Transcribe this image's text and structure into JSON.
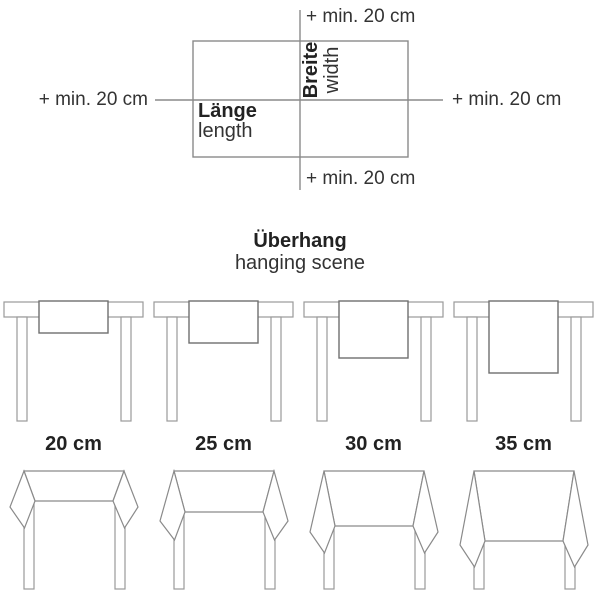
{
  "top_diagram": {
    "annotation_top": "+ min. 20 cm",
    "annotation_bottom": "+ min. 20 cm",
    "annotation_left": "+ min. 20 cm",
    "annotation_right": "+ min. 20 cm",
    "width_label_de": "Breite",
    "width_label_en": "width",
    "length_label_de": "Länge",
    "length_label_en": "length"
  },
  "section": {
    "title_de": "Überhang",
    "title_en": "hanging scene"
  },
  "overhang_options": [
    {
      "label": "20 cm"
    },
    {
      "label": "25 cm"
    },
    {
      "label": "30 cm"
    },
    {
      "label": "35 cm"
    }
  ],
  "colors": {
    "diagram_line": "#8a8a8a",
    "cloth_line": "#6f6f6f",
    "text": "#2b2b2b"
  }
}
